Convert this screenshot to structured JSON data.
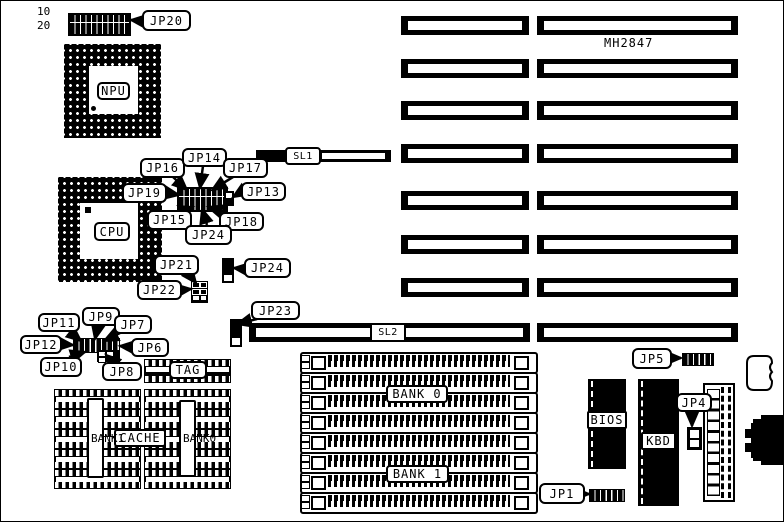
{
  "board": {
    "model": "MH2847",
    "jp20_pin_top": "10",
    "jp20_pin_bottom": "20"
  },
  "chips": {
    "npu": "NPU",
    "cpu": "CPU",
    "tag": "TAG",
    "cache": "CACHE",
    "bank1_column": "BANK1",
    "bank0_column": "BANK0",
    "bios": "BIOS",
    "kbd": "KBD"
  },
  "slots": {
    "sl1": "SL1",
    "sl2": "SL2"
  },
  "memory": {
    "bank0": "BANK 0",
    "bank1": "BANK 1"
  },
  "jumpers": {
    "jp1": "JP1",
    "jp4": "JP4",
    "jp5": "JP5",
    "jp6": "JP6",
    "jp7": "JP7",
    "jp8": "JP8",
    "jp9": "JP9",
    "jp10": "JP10",
    "jp11": "JP11",
    "jp12": "JP12",
    "jp13": "JP13",
    "jp14": "JP14",
    "jp15": "JP15",
    "jp16": "JP16",
    "jp17": "JP17",
    "jp18": "JP18",
    "jp19": "JP19",
    "jp20": "JP20",
    "jp21": "JP21",
    "jp22": "JP22",
    "jp23": "JP23",
    "jp24_center": "JP24",
    "jp24_right": "JP24"
  },
  "colors": {
    "ink": "#000000",
    "paper": "#ffffff"
  }
}
